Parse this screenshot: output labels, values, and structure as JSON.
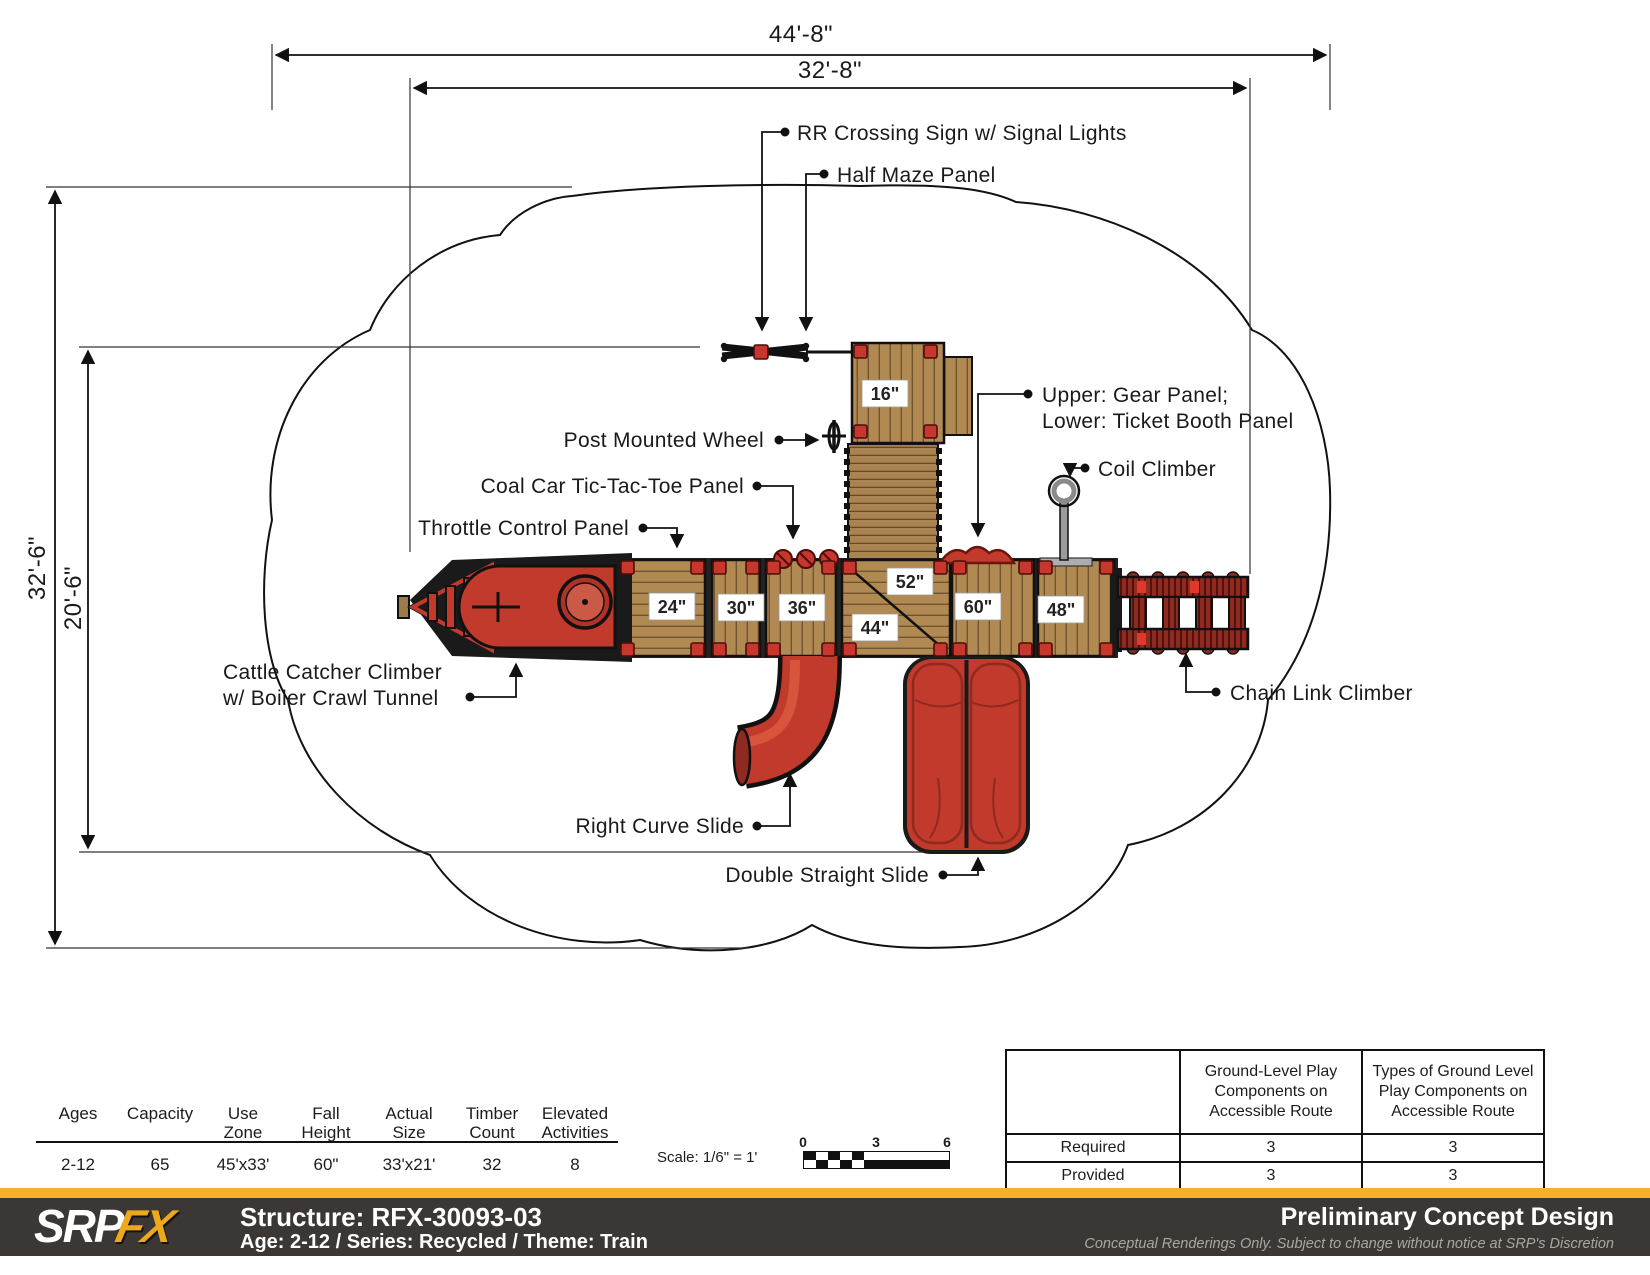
{
  "dims": {
    "top_outer": "44'-8\"",
    "top_inner": "32'-8\"",
    "left_outer": "32'-6\"",
    "left_inner": "20'-6\""
  },
  "callouts": {
    "rr_crossing": "RR Crossing Sign w/ Signal Lights",
    "half_maze": "Half Maze Panel",
    "post_wheel": "Post Mounted Wheel",
    "gear_upper": "Upper: Gear Panel;",
    "gear_lower": "Lower: Ticket Booth Panel",
    "coil": "Coil Climber",
    "tictactoe": "Coal Car Tic-Tac-Toe Panel",
    "throttle": "Throttle Control Panel",
    "cattle_line1": "Cattle Catcher Climber",
    "cattle_line2": "w/ Boiler Crawl Tunnel",
    "curve_slide": "Right Curve Slide",
    "double_slide": "Double Straight Slide",
    "chain_link": "Chain Link Climber"
  },
  "deck_labels": [
    "16\"",
    "24\"",
    "30\"",
    "36\"",
    "52\"",
    "44\"",
    "60\"",
    "48\""
  ],
  "stats": {
    "columns": [
      {
        "l1": "",
        "l2": "Ages",
        "value": "2-12"
      },
      {
        "l1": "",
        "l2": "Capacity",
        "value": "65"
      },
      {
        "l1": "Use",
        "l2": "Zone",
        "value": "45'x33'"
      },
      {
        "l1": "Fall",
        "l2": "Height",
        "value": "60\""
      },
      {
        "l1": "Actual",
        "l2": "Size",
        "value": "33'x21'"
      },
      {
        "l1": "Timber",
        "l2": "Count",
        "value": "32"
      },
      {
        "l1": "Elevated",
        "l2": "Activities",
        "value": "8"
      }
    ]
  },
  "scale": {
    "label": "Scale: 1/6\" = 1'",
    "ticks": [
      "0",
      "3",
      "6"
    ]
  },
  "access_table": {
    "col2_header": "Ground-Level Play\nComponents on\nAccessible Route",
    "col3_header": "Types of Ground Level\nPlay Components on\nAccessible Route",
    "rows": [
      {
        "label": "Required",
        "c1": "3",
        "c2": "3"
      },
      {
        "label": "Provided",
        "c1": "3",
        "c2": "3"
      }
    ]
  },
  "footer": {
    "logo_srp": "SRP",
    "logo_fx": "FX",
    "structure": "Structure: RFX-30093-03",
    "meta": "Age: 2-12 / Series: Recycled / Theme: Train",
    "title": "Preliminary Concept Design",
    "disclaimer": "Conceptual Renderings Only. Subject to change without notice at SRP's Discretion",
    "accent_yellow": "#F2B32A",
    "bar_dark": "#3B3734",
    "deck_wood": "#B08A52",
    "play_red": "#C13A2B"
  }
}
